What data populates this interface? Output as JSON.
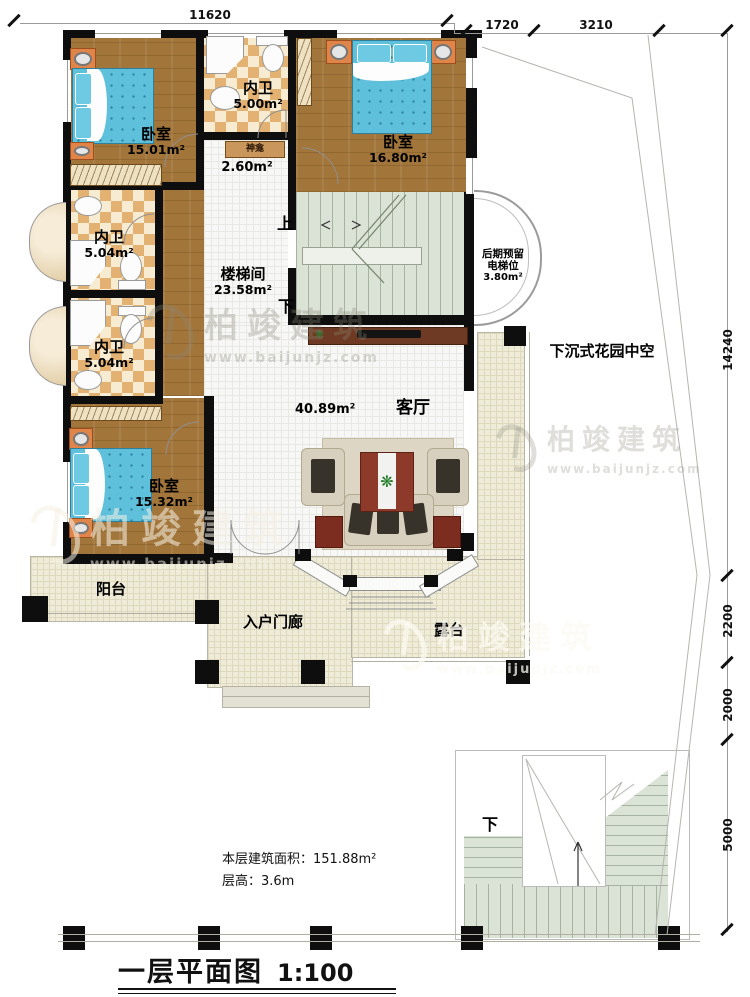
{
  "plan": {
    "title": "一层平面图",
    "scale": "1:100",
    "floor_area_label": "本层建筑面积：151.88m²",
    "floor_height_label": "层高：3.6m"
  },
  "dimensions": {
    "top": "11620",
    "top_right_1": "1720",
    "top_right_2": "3210",
    "right_1": "14240",
    "right_2": "2200",
    "right_3": "2000",
    "right_4": "5000"
  },
  "rooms": {
    "bedroom_tl": {
      "name": "卧室",
      "area": "15.01m²"
    },
    "bath_top": {
      "name": "内卫",
      "area": "5.00m²"
    },
    "shrine": {
      "name": "神龛",
      "area": "2.60m²"
    },
    "bedroom_tr": {
      "name": "卧室",
      "area": "16.80m²"
    },
    "stair_hall": {
      "name": "楼梯间",
      "area": "23.58m²"
    },
    "bath_mid": {
      "name": "内卫",
      "area": "5.04m²"
    },
    "bath_low": {
      "name": "内卫",
      "area": "5.04m²"
    },
    "bedroom_bl": {
      "name": "卧室",
      "area": "15.32m²"
    },
    "living": {
      "name": "客厅",
      "area": "40.89m²"
    },
    "elevator": {
      "line1": "后期预留",
      "line2": "电梯位",
      "area": "3.80m²"
    },
    "sunken_garden": {
      "name": "下沉式花园中空"
    },
    "balcony": {
      "name": "阳台"
    },
    "porch": {
      "name": "入户门廊"
    },
    "terrace": {
      "name": "露台"
    }
  },
  "stairs": {
    "up": "上",
    "down": "下",
    "outdoor_down": "下"
  },
  "watermark": {
    "brand": "柏竣建筑",
    "url": "www.baijunjz.com"
  },
  "colors": {
    "wall": "#0e0e0e",
    "wood_floor": "#a2753a",
    "tile_checker": "#e3b272",
    "stair_green": "#dbe2d6",
    "outdoor_beige": "#eeecd8",
    "bed_blue": "#5fc0dc",
    "rug_red": "#8d3a2a"
  }
}
